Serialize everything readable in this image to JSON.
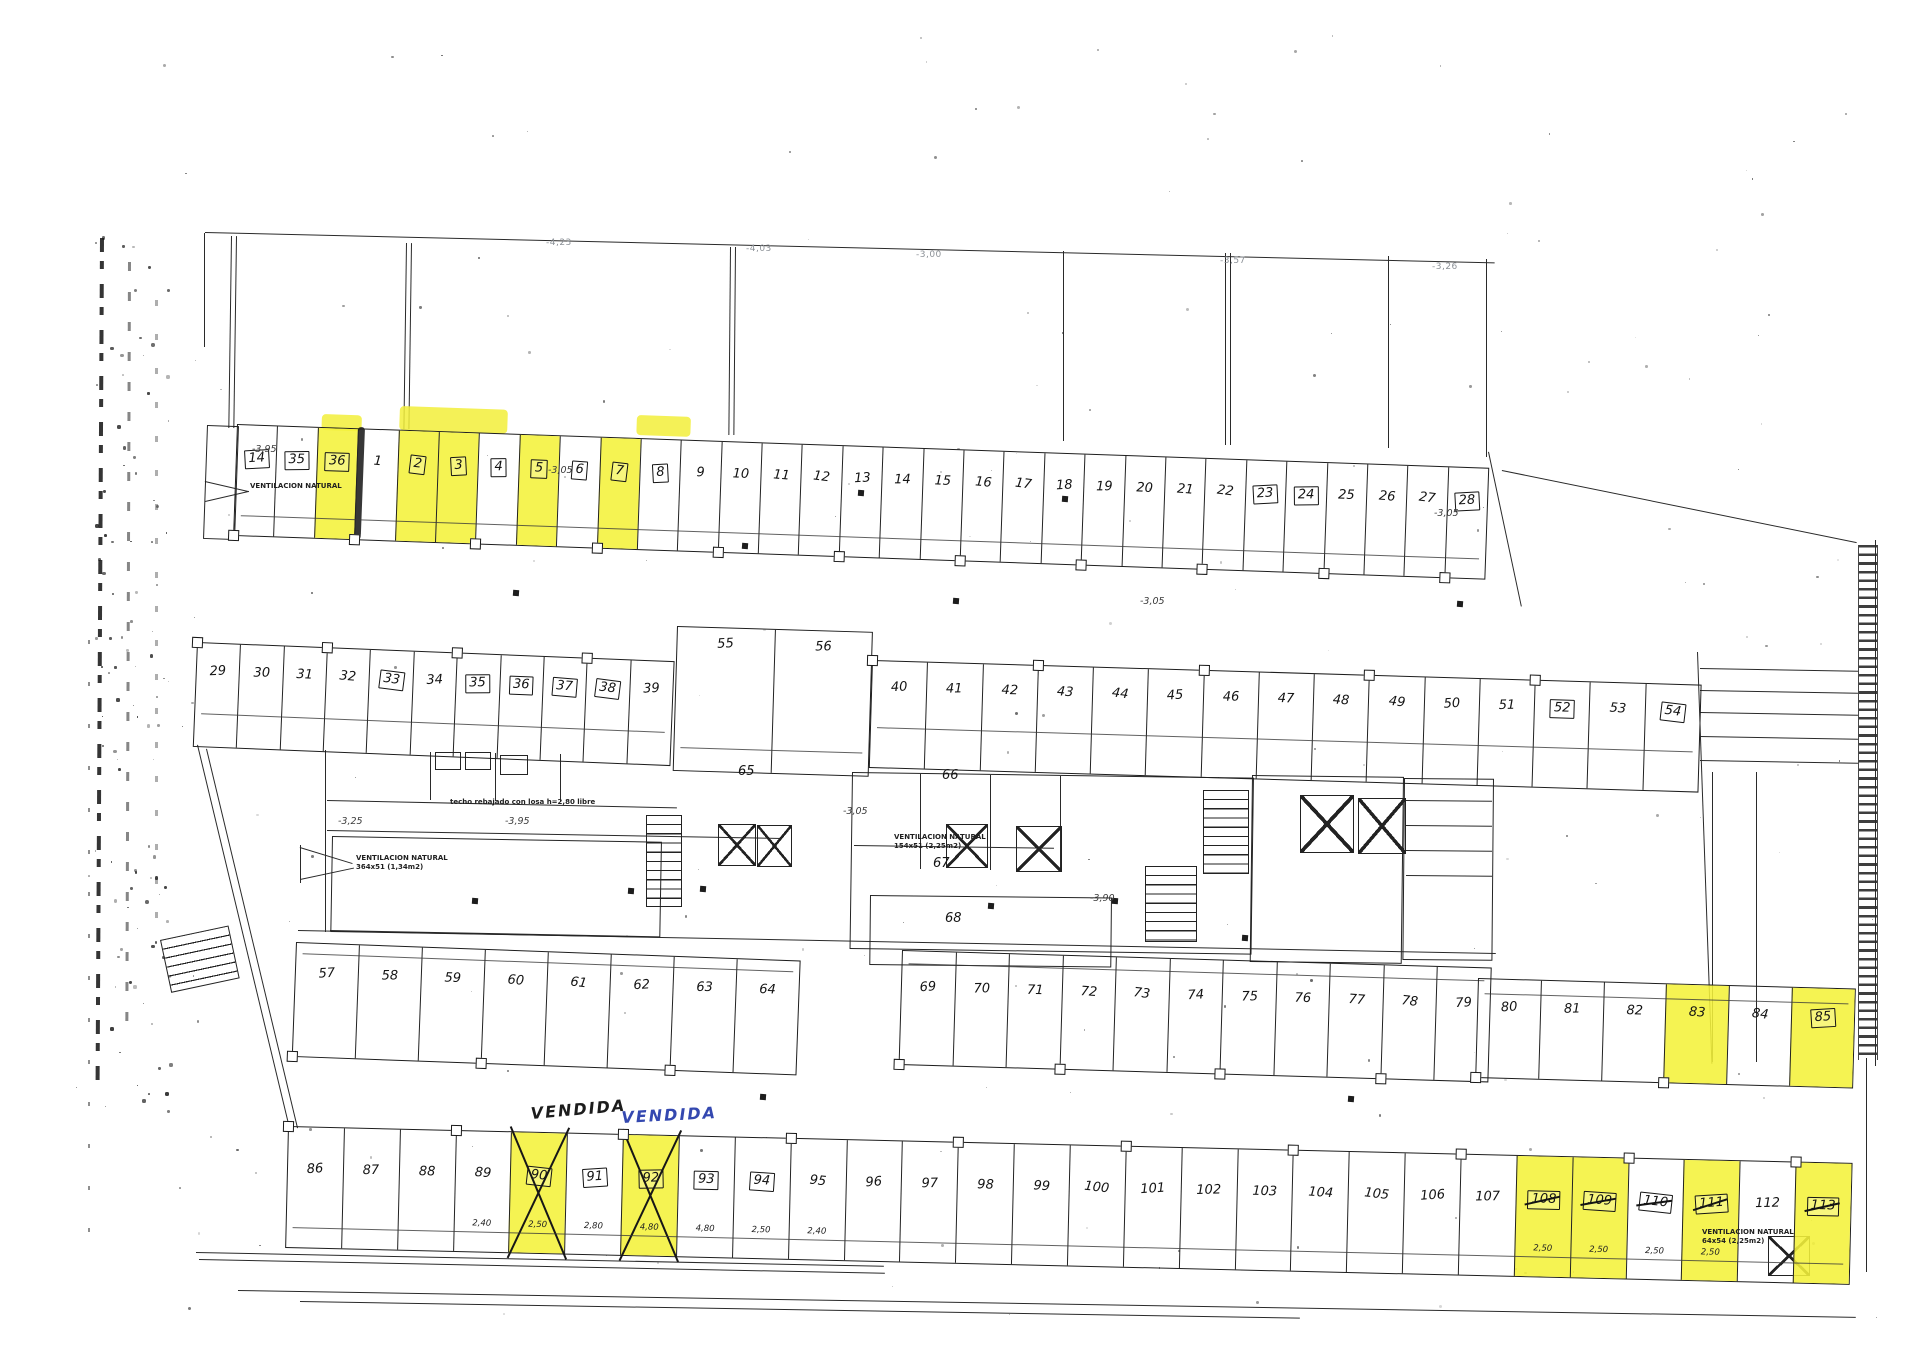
{
  "document": {
    "kind": "scanned parking garage floor plan",
    "highlighter_color": "#f2ef3a",
    "pen_blue": "#3448b0",
    "ink": "#1f1f1f"
  },
  "elevation_marks": [
    {
      "text": "-4,23",
      "x": 546,
      "y": 238
    },
    {
      "text": "-4,03",
      "x": 746,
      "y": 244
    },
    {
      "text": "-3,00",
      "x": 916,
      "y": 250
    },
    {
      "text": "-3,57",
      "x": 1220,
      "y": 256
    },
    {
      "text": "-3,26",
      "x": 1432,
      "y": 262
    }
  ],
  "level_labels": [
    {
      "text": "-3,95",
      "x": 252,
      "y": 444
    },
    {
      "text": "-3,05",
      "x": 548,
      "y": 465
    },
    {
      "text": "-3,05",
      "x": 1140,
      "y": 596
    },
    {
      "text": "-3,05",
      "x": 1434,
      "y": 508
    },
    {
      "text": "-3,05",
      "x": 843,
      "y": 806
    },
    {
      "text": "-3,95",
      "x": 505,
      "y": 816
    },
    {
      "text": "-3,25",
      "x": 338,
      "y": 816
    },
    {
      "text": "-3,90",
      "x": 1090,
      "y": 893
    }
  ],
  "annotations": [
    {
      "x": 250,
      "y": 482,
      "lines": [
        "VENTILACION NATURAL"
      ]
    },
    {
      "x": 356,
      "y": 854,
      "lines": [
        "VENTILACION NATURAL",
        "364x51 (1,34m2)"
      ]
    },
    {
      "x": 894,
      "y": 833,
      "lines": [
        "VENTILACION NATURAL",
        "154x51 (2,25m2)"
      ]
    },
    {
      "x": 1702,
      "y": 1228,
      "lines": [
        "VENTILACION NATURAL",
        "64x54 (2,25m2)"
      ]
    },
    {
      "x": 450,
      "y": 798,
      "lines": [
        "techo rebajado con losa h=2,80 libre"
      ]
    }
  ],
  "core_labels": [
    {
      "text": "65",
      "x": 738,
      "y": 764
    },
    {
      "text": "66",
      "x": 942,
      "y": 768
    },
    {
      "text": "67",
      "x": 933,
      "y": 856
    },
    {
      "text": "68",
      "x": 945,
      "y": 911
    }
  ],
  "vendida_notes": [
    {
      "text": "VENDIDA",
      "x": 530,
      "y": 1104,
      "ink": "#1c1c1c",
      "rot": -5
    },
    {
      "text": "VENDIDA",
      "x": 621,
      "y": 1108,
      "ink": "#3448b0",
      "rot": -3
    }
  ],
  "rows": [
    {
      "name": "top-row",
      "x": 237,
      "y": 424,
      "w": 1253,
      "h": 112,
      "angle": 2.0,
      "num_y": 24,
      "dim_y": 90,
      "pillars": "bottom",
      "stalls": [
        {
          "n": "14",
          "b": true
        },
        {
          "n": "35",
          "b": true
        },
        {
          "n": "36",
          "b": true,
          "y": true
        },
        {
          "n": "1"
        },
        {
          "n": "2",
          "b": true,
          "y": true
        },
        {
          "n": "3",
          "b": true,
          "y": true
        },
        {
          "n": "4",
          "b": true
        },
        {
          "n": "5",
          "b": true,
          "y": true
        },
        {
          "n": "6",
          "b": true
        },
        {
          "n": "7",
          "b": true,
          "y": true
        },
        {
          "n": "8",
          "b": true
        },
        {
          "n": "9"
        },
        {
          "n": "10"
        },
        {
          "n": "11"
        },
        {
          "n": "12"
        },
        {
          "n": "13"
        },
        {
          "n": "14"
        },
        {
          "n": "15"
        },
        {
          "n": "16"
        },
        {
          "n": "17"
        },
        {
          "n": "18"
        },
        {
          "n": "19"
        },
        {
          "n": "20"
        },
        {
          "n": "21"
        },
        {
          "n": "22"
        },
        {
          "n": "23",
          "b": true
        },
        {
          "n": "24",
          "b": true
        },
        {
          "n": "25"
        },
        {
          "n": "26"
        },
        {
          "n": "27"
        },
        {
          "n": "28",
          "b": true
        }
      ]
    },
    {
      "name": "row-29-39",
      "x": 197,
      "y": 642,
      "w": 478,
      "h": 105,
      "angle": 2.3,
      "num_y": 20,
      "dim_y": 70,
      "pillars": "top",
      "stalls": [
        {
          "n": "29"
        },
        {
          "n": "30"
        },
        {
          "n": "31"
        },
        {
          "n": "32"
        },
        {
          "n": "33",
          "b": true
        },
        {
          "n": "34"
        },
        {
          "n": "35",
          "b": true
        },
        {
          "n": "36",
          "b": true
        },
        {
          "n": "37",
          "b": true
        },
        {
          "n": "38",
          "b": true
        },
        {
          "n": "39"
        }
      ]
    },
    {
      "name": "row-55-56",
      "x": 677,
      "y": 626,
      "w": 196,
      "h": 145,
      "angle": 1.7,
      "num_y": 8,
      "dim_y": 120,
      "pillars": "",
      "stalls": [
        {
          "n": "55"
        },
        {
          "n": "56"
        }
      ]
    },
    {
      "name": "row-40-54",
      "x": 872,
      "y": 660,
      "w": 830,
      "h": 108,
      "angle": 1.7,
      "num_y": 18,
      "dim_y": 66,
      "pillars": "top",
      "stalls": [
        {
          "n": "40"
        },
        {
          "n": "41"
        },
        {
          "n": "42"
        },
        {
          "n": "43"
        },
        {
          "n": "44"
        },
        {
          "n": "45"
        },
        {
          "n": "46"
        },
        {
          "n": "47"
        },
        {
          "n": "48"
        },
        {
          "n": "49"
        },
        {
          "n": "50"
        },
        {
          "n": "51"
        },
        {
          "n": "52",
          "b": true
        },
        {
          "n": "53"
        },
        {
          "n": "54",
          "b": true
        }
      ]
    },
    {
      "name": "row-57-64",
      "x": 296,
      "y": 942,
      "w": 505,
      "h": 115,
      "angle": 2.1,
      "num_y": 22,
      "dim_y": 10,
      "pillars": "bottom",
      "stalls": [
        {
          "n": "57"
        },
        {
          "n": "58"
        },
        {
          "n": "59"
        },
        {
          "n": "60"
        },
        {
          "n": "61"
        },
        {
          "n": "62"
        },
        {
          "n": "63"
        },
        {
          "n": "64"
        }
      ]
    },
    {
      "name": "row-69-79",
      "x": 902,
      "y": 950,
      "w": 590,
      "h": 115,
      "angle": 1.7,
      "num_y": 28,
      "dim_y": 12,
      "pillars": "bottom",
      "stalls": [
        {
          "n": "69"
        },
        {
          "n": "70"
        },
        {
          "n": "71"
        },
        {
          "n": "72"
        },
        {
          "n": "73"
        },
        {
          "n": "74"
        },
        {
          "n": "75"
        },
        {
          "n": "76"
        },
        {
          "n": "77"
        },
        {
          "n": "78"
        },
        {
          "n": "79"
        }
      ]
    },
    {
      "name": "row-80-85",
      "x": 1478,
      "y": 978,
      "w": 378,
      "h": 100,
      "angle": 1.6,
      "num_y": 20,
      "dim_y": 14,
      "pillars": "bottom",
      "stalls": [
        {
          "n": "80"
        },
        {
          "n": "81"
        },
        {
          "n": "82"
        },
        {
          "n": "83",
          "y": true
        },
        {
          "n": "84"
        },
        {
          "n": "85",
          "b": true,
          "y": true
        }
      ]
    },
    {
      "name": "row-86-113",
      "x": 288,
      "y": 1126,
      "w": 1565,
      "h": 122,
      "angle": 1.35,
      "num_y": 34,
      "dim_y": 100,
      "pillars": "top",
      "stalls": [
        {
          "n": "86"
        },
        {
          "n": "87"
        },
        {
          "n": "88"
        },
        {
          "n": "89",
          "d": "2,40"
        },
        {
          "n": "90",
          "b": true,
          "y": true,
          "x": true,
          "d": "2,50"
        },
        {
          "n": "91",
          "b": true,
          "d": "2,80"
        },
        {
          "n": "92",
          "b": true,
          "y": true,
          "x": true,
          "d": "4,80"
        },
        {
          "n": "93",
          "b": true,
          "d": "4,80"
        },
        {
          "n": "94",
          "b": true,
          "d": "2,50"
        },
        {
          "n": "95",
          "d": "2,40"
        },
        {
          "n": "96"
        },
        {
          "n": "97"
        },
        {
          "n": "98"
        },
        {
          "n": "99"
        },
        {
          "n": "100"
        },
        {
          "n": "101"
        },
        {
          "n": "102"
        },
        {
          "n": "103"
        },
        {
          "n": "104"
        },
        {
          "n": "105"
        },
        {
          "n": "106"
        },
        {
          "n": "107"
        },
        {
          "n": "108",
          "b": true,
          "y": true,
          "s": true,
          "d": "2,50"
        },
        {
          "n": "109",
          "b": true,
          "y": true,
          "s": true,
          "d": "2,50"
        },
        {
          "n": "110",
          "b": true,
          "s": true,
          "d": "2,50"
        },
        {
          "n": "111",
          "b": true,
          "y": true,
          "s": true,
          "d": "2,50"
        },
        {
          "n": "112"
        },
        {
          "n": "113",
          "b": true,
          "y": true,
          "s": true
        }
      ]
    }
  ]
}
